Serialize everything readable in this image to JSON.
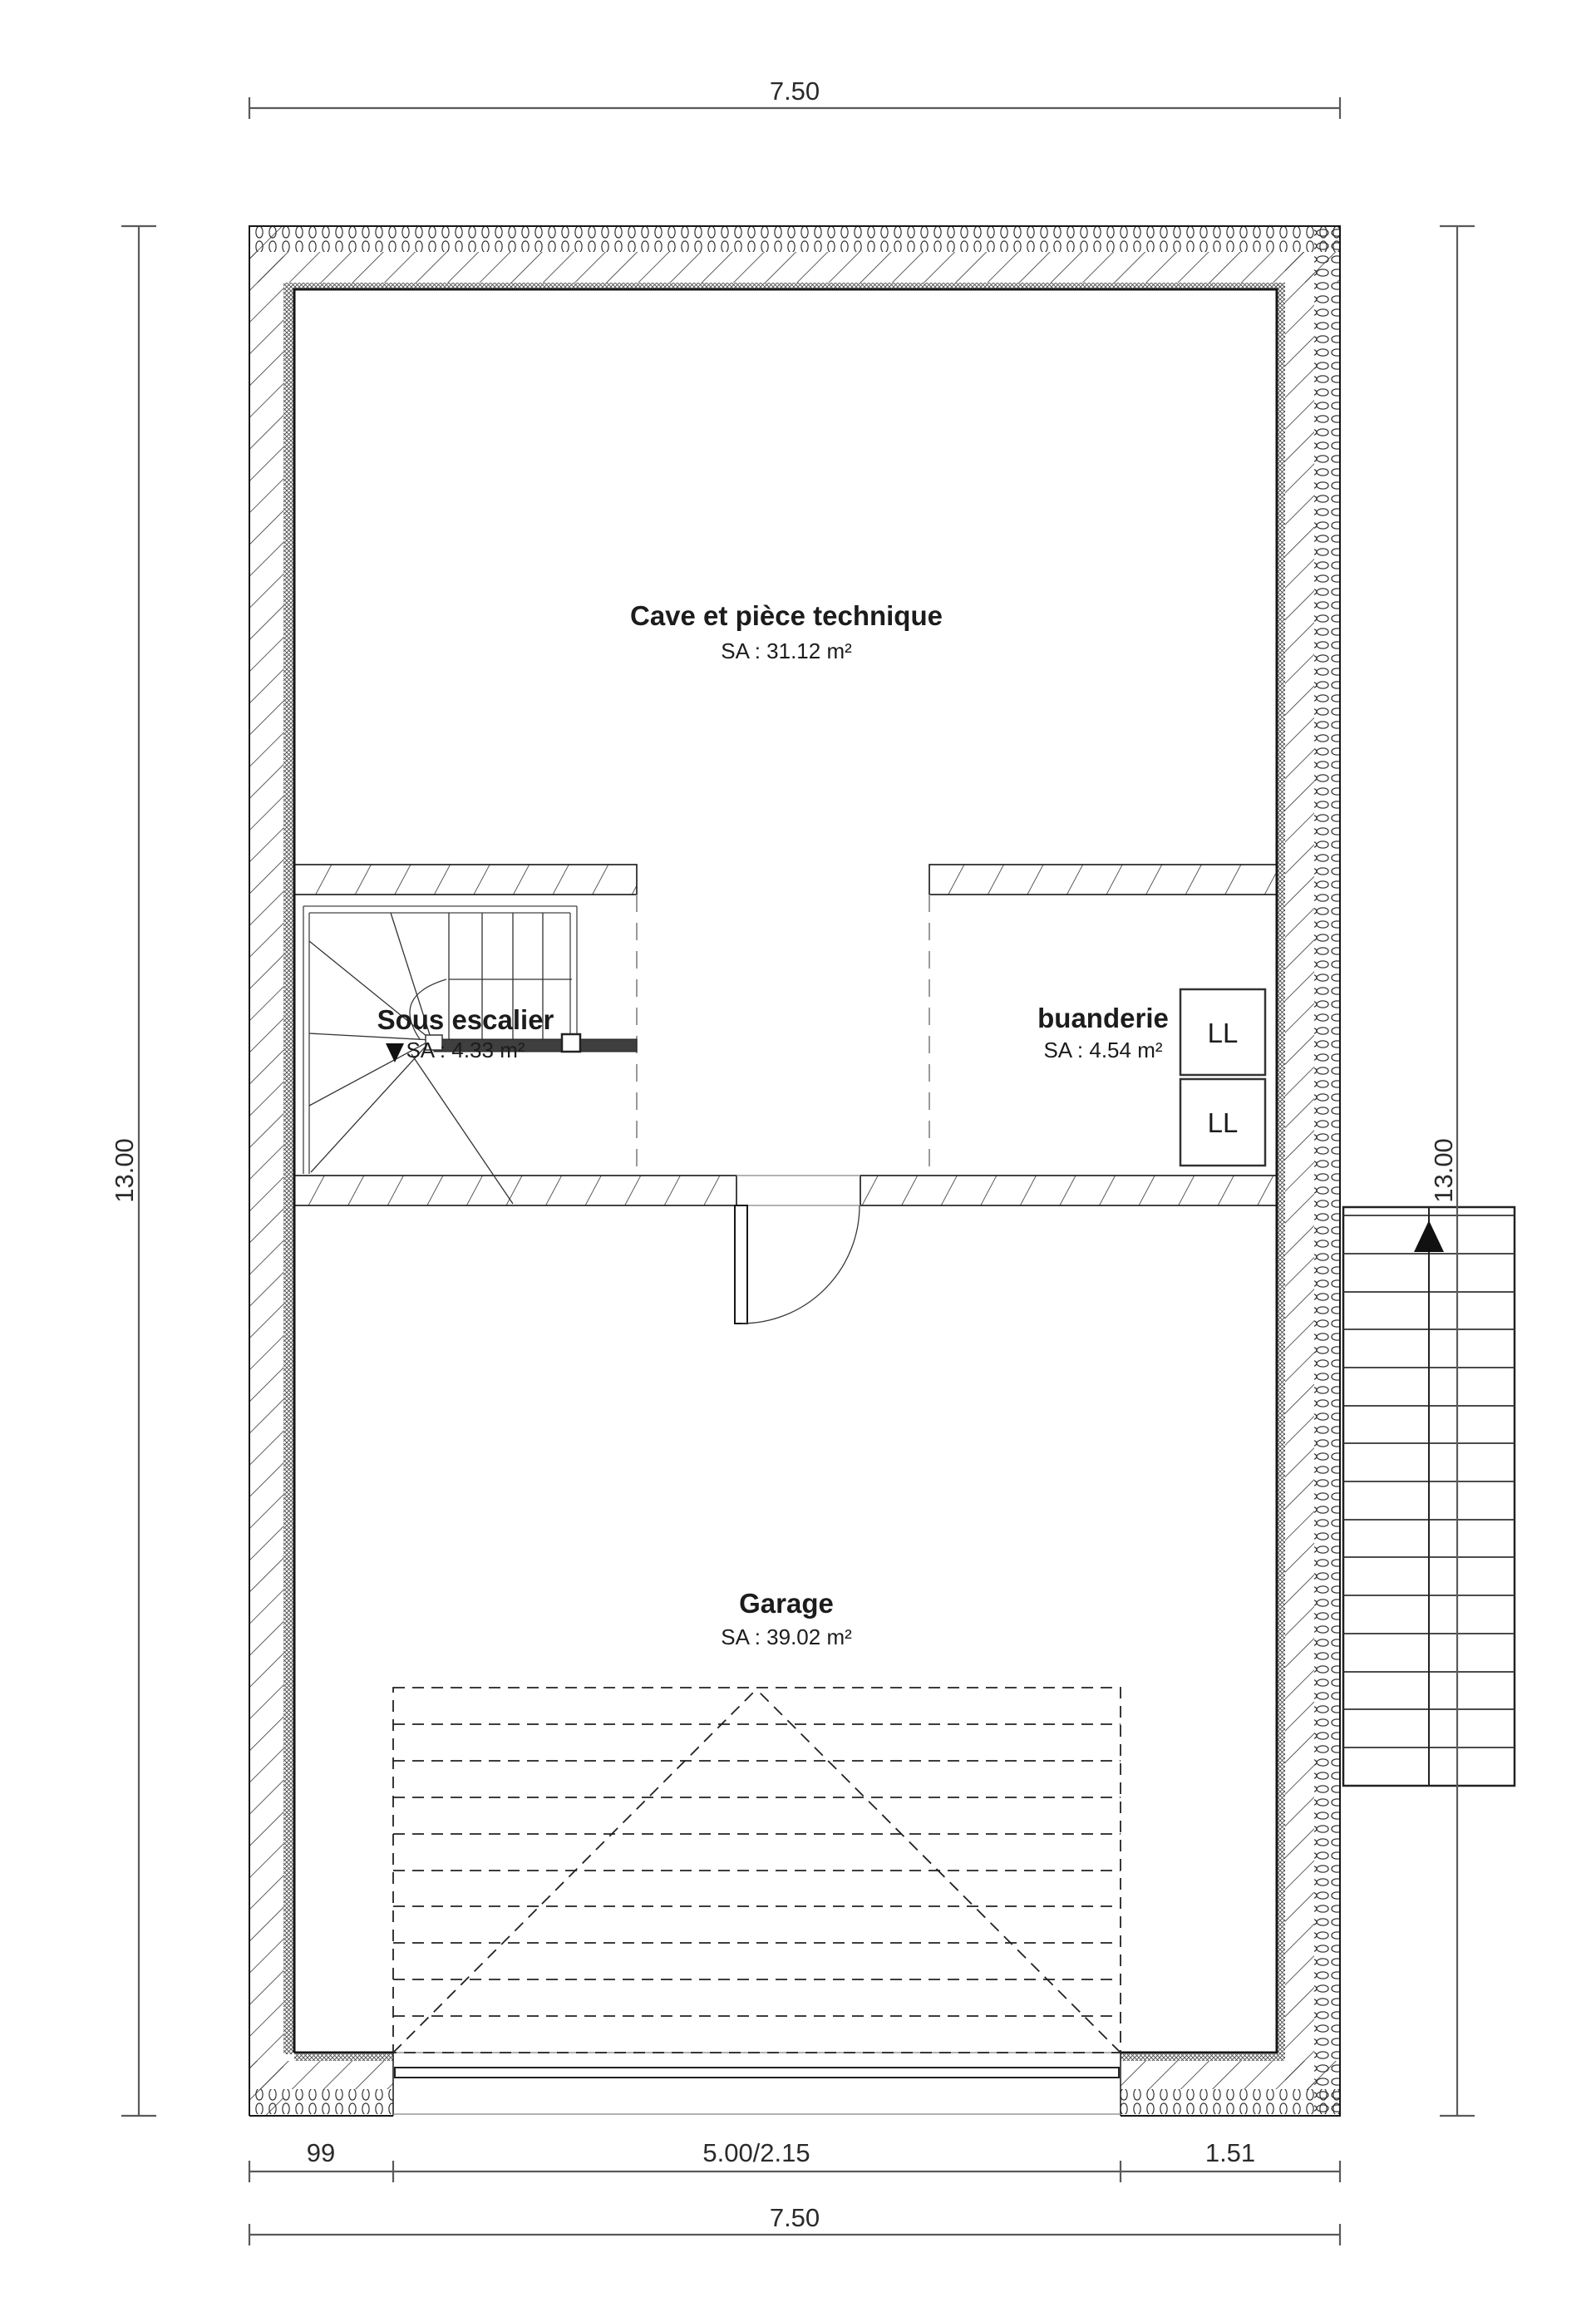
{
  "plan": {
    "dimensions": {
      "top_width": "7.50",
      "left_height": "13.00",
      "right_height": "13.00",
      "bottom_left": "99",
      "bottom_middle": "5.00/2.15",
      "bottom_right": "1.51",
      "bottom_total": "7.50"
    },
    "rooms": {
      "cave": {
        "name": "Cave et pièce technique",
        "area": "SA : 31.12 m²"
      },
      "sous_escalier": {
        "name": "Sous escalier",
        "area": "SA : 4.33 m²"
      },
      "buanderie": {
        "name": "buanderie",
        "area": "SA : 4.54 m²"
      },
      "garage": {
        "name": "Garage",
        "area": "SA : 39.02 m²"
      }
    },
    "appliances": {
      "washer1": "LL",
      "washer2": "LL"
    },
    "colors": {
      "line": "#1c1c1c",
      "dimension": "#5a5a5a",
      "dashed_guide": "#9a9a9a",
      "stair_bar": "#3f3f3f",
      "background": "#ffffff"
    }
  }
}
